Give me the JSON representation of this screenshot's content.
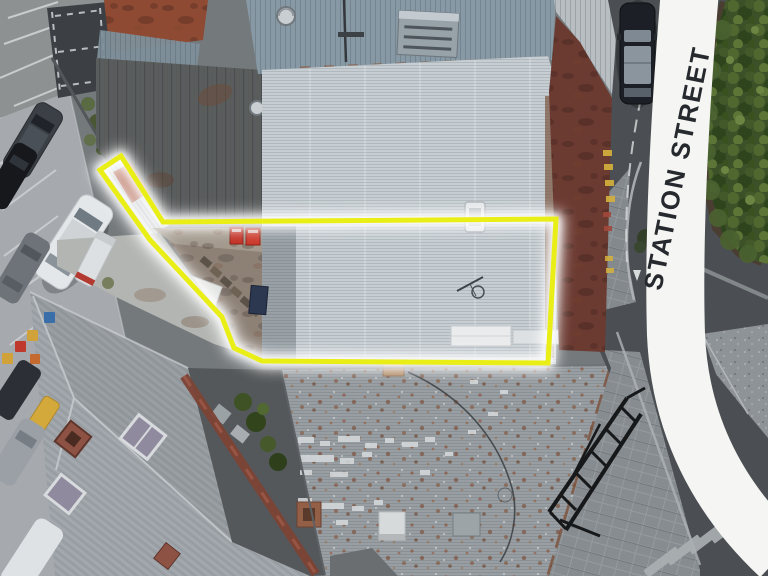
{
  "scene": {
    "type": "aerial-drone-photo",
    "street": {
      "label": "STATION STREET",
      "banner_color": "#f5f6f3",
      "label_color": "#26292e",
      "band_path": "M 690,-10 C 680,110 673,235 676,335 C 680,425 718,498 780,556"
    },
    "boundary": {
      "color": "#e9ee17",
      "glow_color": "#ffffff",
      "points": "100,170 121,156 163,222 556,219 548,363 262,361 234,348 222,317 150,240"
    },
    "colors": {
      "street": "#a6aaae",
      "road": "#4b4f53",
      "sidewalk": "#868c90",
      "median": "#8e9397",
      "zebra": "#abb1b3",
      "main_roof": "#c7ced3",
      "main_roof_dark": "#99a1a7",
      "top_roof": "#8799a4",
      "top_right_roof": "#b8bec2",
      "south_roof": "#989ea2",
      "hip_roof": "#9da3a8",
      "weathered_roof": "#5a5d5e",
      "courtyard": "#8d8176",
      "lane": "#b2b5b1",
      "maroon_roof": "#6b3a31",
      "hedge": "#3c5128",
      "strip_roof": "#cfd4d6",
      "strip_rust": "#a64a30",
      "rust_roof": "#8f4a33",
      "tarp": "#3c4044"
    }
  }
}
